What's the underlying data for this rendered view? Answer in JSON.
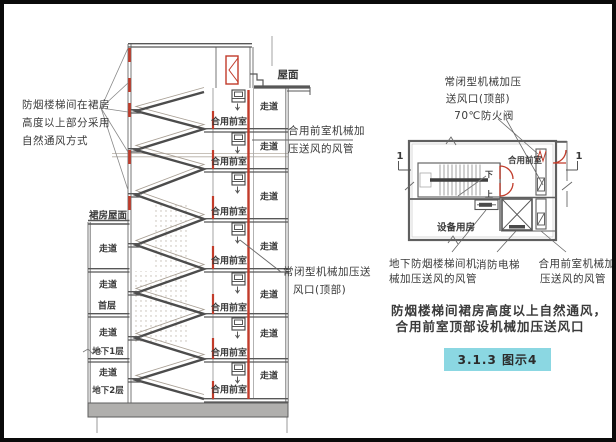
{
  "section_view": {
    "roof_label": "屋面",
    "podium_roof_label": "裙房屋面",
    "natural_vent_note": [
      "防烟楼梯间在裙房",
      "高度以上部分采用",
      "自然通风方式"
    ],
    "corridor_labels": [
      "走道",
      "走道",
      "走道",
      "走道",
      "走道",
      "走道",
      "走道"
    ],
    "lobby_labels": [
      "合用前室",
      "合用前室",
      "合用前室",
      "合用前室",
      "合用前室",
      "合用前室",
      "合用前室"
    ],
    "left_corridors": [
      "走道",
      "走道",
      "走道",
      "走道"
    ],
    "floor_tags": {
      "first": "首层",
      "b1": "地下1层",
      "b2": "地下2层"
    },
    "duct_note": [
      "合用前室机械加",
      "压送风的风管"
    ],
    "outlet_note": [
      "常闭型机械加压送",
      "风口(顶部)"
    ]
  },
  "plan_view": {
    "outlet_note": [
      "常闭型机械加压",
      "送风口(顶部)"
    ],
    "damper_note": "70℃防火阀",
    "lobby_label": "合用前室",
    "equipment_room_label": "设备用房",
    "stair_down": "下",
    "stair_up": "上",
    "section_marker": "1",
    "basement_duct_note": [
      "地下防烟楼梯间机",
      "械加压送风的风管"
    ],
    "fire_elevator_label": "消防电梯",
    "lobby_duct_note": [
      "合用前室机械加",
      "压送风的风管"
    ]
  },
  "caption": {
    "line1": "防烟楼梯间裙房高度以上自然通风，",
    "line2": "合用前室顶部设机械加压送风口",
    "figure_badge": "3.1.3 图示4"
  },
  "colors": {
    "line_gray": "#6a6a6a",
    "slab_dark": "#575757",
    "accent_red": "#c13b2a",
    "base_slab_fill": "#b0afad",
    "badge_bg": "#8bd7e2",
    "text": "#3a3a3a"
  }
}
